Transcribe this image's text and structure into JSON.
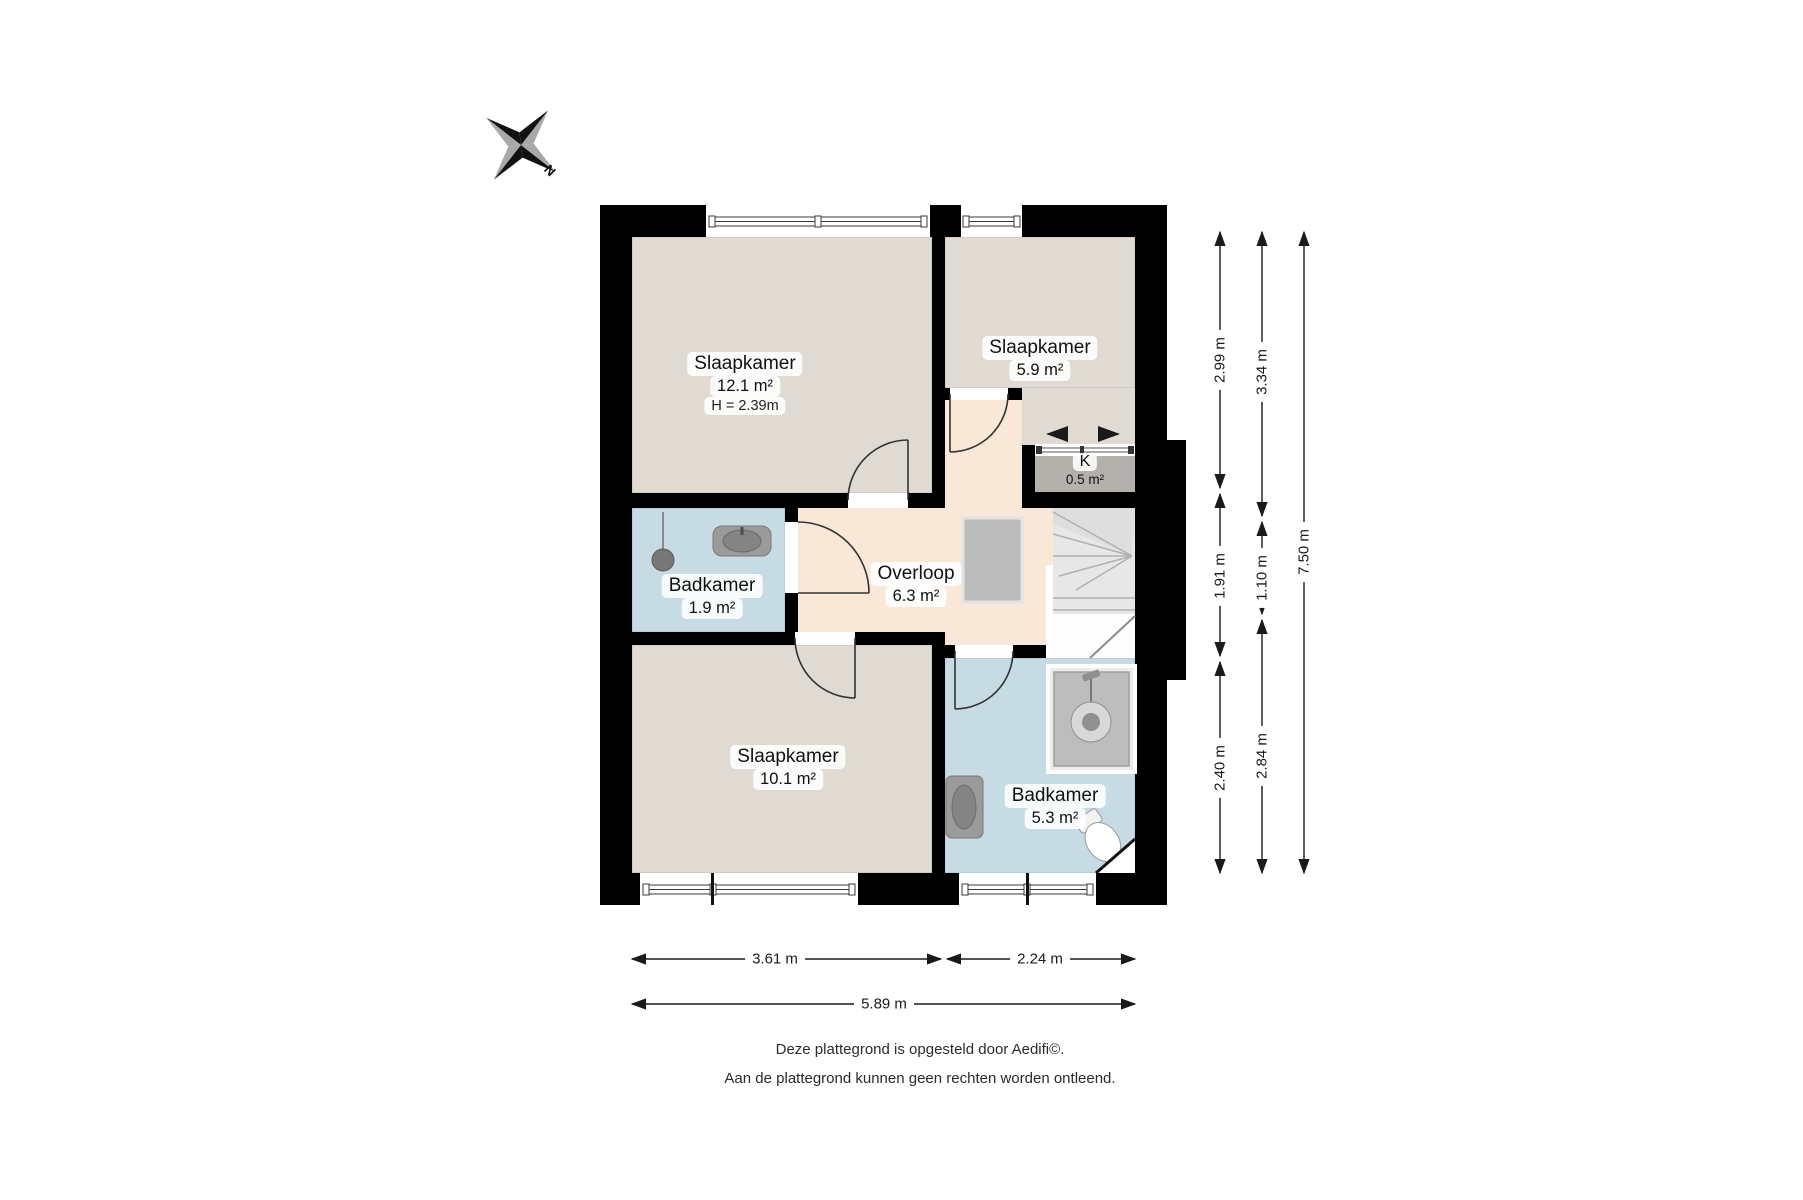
{
  "compass": {
    "north_label": "N"
  },
  "rooms": [
    {
      "name": "Slaapkamer",
      "area": "12.1 m²",
      "height": "H = 2.39m"
    },
    {
      "name": "Slaapkamer",
      "area": "5.9 m²"
    },
    {
      "name": "K",
      "area": "0.5 m²"
    },
    {
      "name": "Badkamer",
      "area": "1.9 m²"
    },
    {
      "name": "Overloop",
      "area": "6.3 m²"
    },
    {
      "name": "Slaapkamer",
      "area": "10.1 m²"
    },
    {
      "name": "Badkamer",
      "area": "5.3 m²"
    }
  ],
  "dimensions": {
    "vertical": [
      "2.99 m",
      "1.91 m",
      "2.40 m",
      "3.34 m",
      "1.10 m",
      "2.84 m",
      "7.50 m"
    ],
    "horizontal": [
      "3.61 m",
      "2.24 m",
      "5.89 m"
    ]
  },
  "footer": {
    "line1": "Deze plattegrond is opgesteld door Aedifi©.",
    "line2": "Aan de plattegrond kunnen geen rechten worden ontleend."
  },
  "colors": {
    "wall": "#000000",
    "room_fill": "#dfdbd3",
    "hallway_fill": "#f9e8d8",
    "bathroom_fill": "#c7dbe4",
    "closet_fill": "#b4b1ad",
    "stairs_fill": "#e7e7e7",
    "dimension_color": "#1a1a1a"
  }
}
